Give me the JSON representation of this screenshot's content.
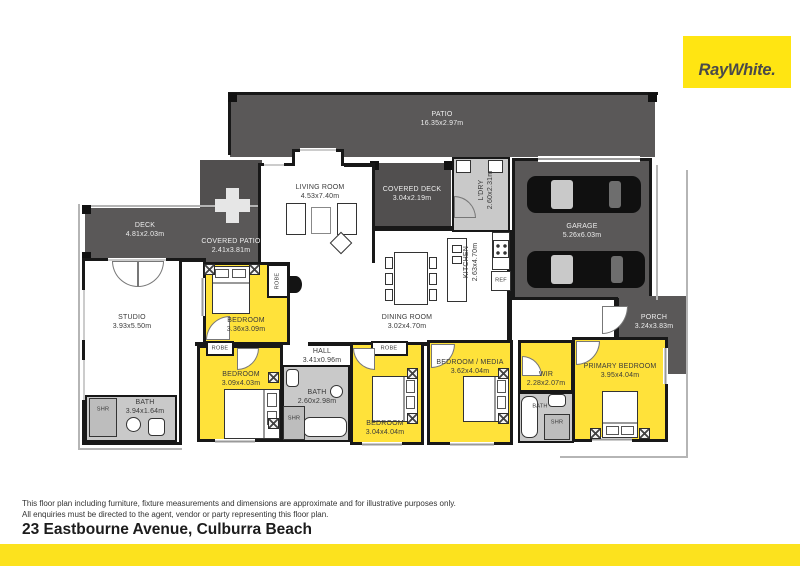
{
  "brand": {
    "logo_text": "RayWhite."
  },
  "colors": {
    "brand_yellow": "#FFE512",
    "room_yellow": "#FFE23A",
    "dark_area": "#5A5858",
    "darker_area": "#514F4F",
    "wet_area_gray": "#C9C9C9",
    "wall": "#181818"
  },
  "rooms": {
    "patio": {
      "name": "PATIO",
      "dims": "16.35x2.97m"
    },
    "living": {
      "name": "LIVING ROOM",
      "dims": "4.53x7.40m"
    },
    "covered_deck": {
      "name": "COVERED DECK",
      "dims": "3.04x2.19m"
    },
    "ldry": {
      "name": "L'DRY",
      "dims": "2.60x2.31m"
    },
    "garage": {
      "name": "GARAGE",
      "dims": "5.26x6.03m"
    },
    "deck": {
      "name": "DECK",
      "dims": "4.81x2.03m"
    },
    "covered_patio": {
      "name": "COVERED PATIO",
      "dims": "2.41x3.81m"
    },
    "studio": {
      "name": "STUDIO",
      "dims": "3.93x5.50m"
    },
    "kitchen": {
      "name": "KITCHEN",
      "dims": "2.63x4.70m"
    },
    "ref": {
      "name": "REF"
    },
    "dining": {
      "name": "DINING ROOM",
      "dims": "3.02x4.70m"
    },
    "porch": {
      "name": "PORCH",
      "dims": "3.24x3.83m"
    },
    "bedroom1": {
      "name": "BEDROOM",
      "dims": "3.36x3.09m"
    },
    "hall": {
      "name": "HALL",
      "dims": "3.41x0.96m"
    },
    "bedroom2": {
      "name": "BEDROOM",
      "dims": "3.09x4.03m"
    },
    "bath_main": {
      "name": "BATH",
      "dims": "2.60x2.98m"
    },
    "bedroom3": {
      "name": "BEDROOM",
      "dims": "3.04x4.04m"
    },
    "media": {
      "name": "BEDROOM / MEDIA",
      "dims": "3.62x4.04m"
    },
    "wir": {
      "name": "WIR",
      "dims": "2.28x2.07m"
    },
    "primary": {
      "name": "PRIMARY BEDROOM",
      "dims": "3.95x4.04m"
    },
    "bath_studio": {
      "name": "BATH",
      "dims": "3.94x1.64m"
    },
    "bath_ensuite": {
      "name": "BATH"
    }
  },
  "labels": {
    "robe": "ROBE",
    "shr": "SHR"
  },
  "footer": {
    "disclaimer_line1": "This floor plan including furniture, fixture measurements and dimensions are approximate and for illustrative purposes only.",
    "disclaimer_line2": "All enquiries must be directed to the agent, vendor or party representing this floor plan.",
    "address": "23 Eastbourne Avenue, Culburra Beach"
  }
}
